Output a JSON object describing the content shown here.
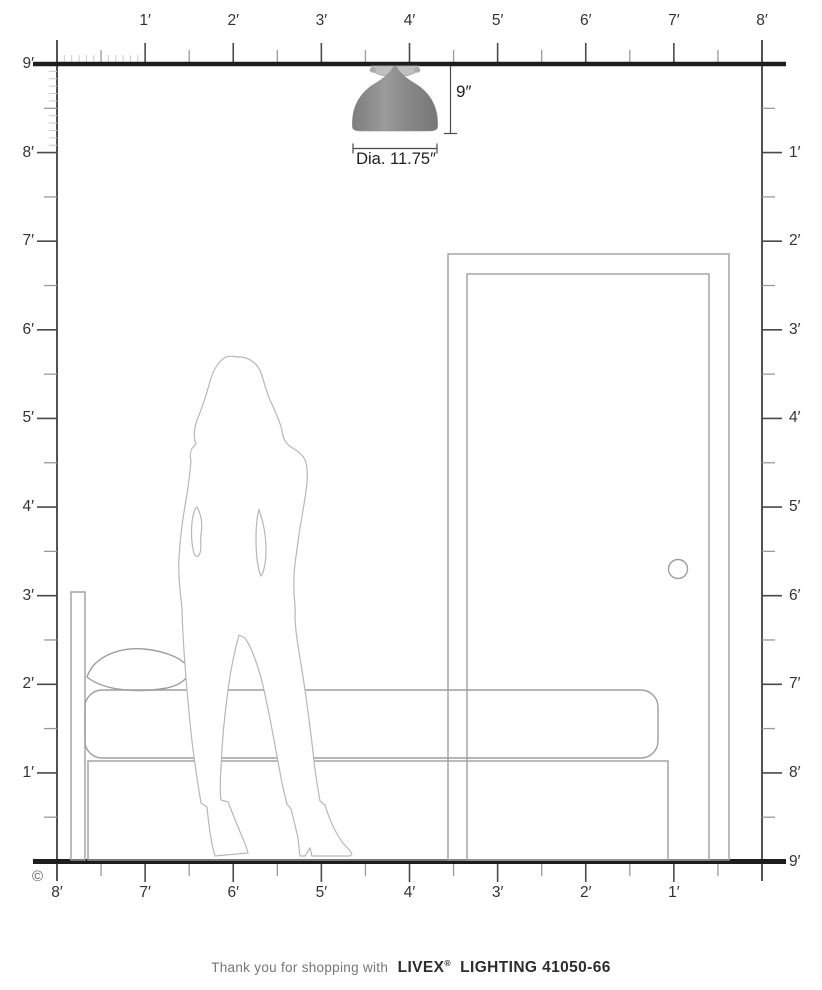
{
  "figure": {
    "copyright": "©",
    "rulers": {
      "top": [
        "1′",
        "2′",
        "3′",
        "4′",
        "5′",
        "6′",
        "7′",
        "8′"
      ],
      "left": [
        "9′",
        "8′",
        "7′",
        "6′",
        "5′",
        "4′",
        "3′",
        "2′",
        "1′"
      ],
      "right": [
        "1′",
        "2′",
        "3′",
        "4′",
        "5′",
        "6′",
        "7′",
        "8′",
        "9′"
      ],
      "bottom": [
        "8′",
        "7′",
        "6′",
        "5′",
        "4′",
        "3′",
        "2′",
        "1′"
      ]
    }
  },
  "fixture": {
    "height_label": "9″",
    "diameter_label": "Dia. 11.75″"
  },
  "scene": {
    "objects": [
      "flush-mount-ceiling-light",
      "woman-silhouette",
      "bed",
      "pillow",
      "door",
      "doorknob"
    ]
  },
  "footer": {
    "thanks": "Thank you for shopping with",
    "brand": "LIVEX",
    "reg": "®",
    "product": "LIGHTING 41050-66"
  },
  "colors": {
    "ceiling_floor_line": "#1d1d1d",
    "ruler_line": "#3f3f3f",
    "foot_tick": "#4a4a4a",
    "half_tick": "#9a9a9a",
    "inch_tick": "#cccccc",
    "scene_outline": "#9e9e9e",
    "silhouette_outline": "#b7b7b7",
    "shade_gray": "#8d8d8d",
    "label_text": "#333333"
  }
}
